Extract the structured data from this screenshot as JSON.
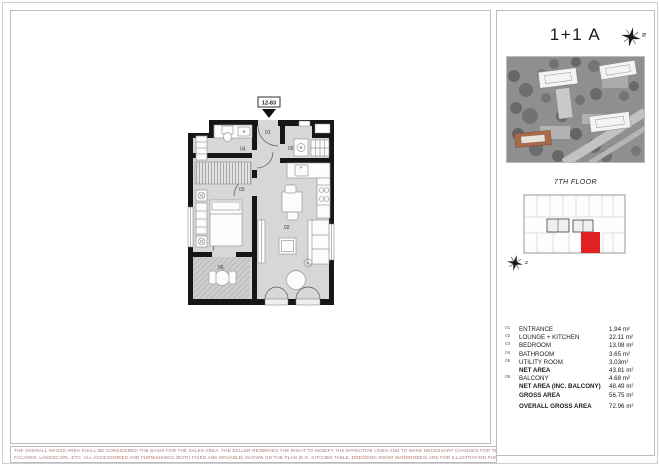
{
  "sheet": {
    "title": "1+1 A",
    "floor_label": "7TH FLOOR",
    "unit_code": "12-83",
    "north_letter": "N"
  },
  "plan": {
    "labels": {
      "entrance": "01",
      "lounge_kitchen": "02",
      "bedroom": "03",
      "bathroom": "04",
      "utility": "05",
      "balcony": "06"
    }
  },
  "legend": {
    "rows": [
      {
        "num": "01",
        "label": "ENTRANCE",
        "value": "1.94 m²"
      },
      {
        "num": "02",
        "label": "LOUNGE + KITCHEN",
        "value": "22.11 m²"
      },
      {
        "num": "03",
        "label": "BEDROOM",
        "value": "13.08 m²"
      },
      {
        "num": "04",
        "label": "BATHROOM",
        "value": "3.65 m²"
      },
      {
        "num": "05",
        "label": "UTILITY ROOM",
        "value": "3.03m²"
      },
      {
        "num": "",
        "label": "NET AREA",
        "value": "43.81 m²"
      },
      {
        "num": "06",
        "label": "BALCONY",
        "value": "4.68 m²"
      },
      {
        "num": "",
        "label": "NET AREA (INC. BALCONY)",
        "value": "48.49 m²"
      },
      {
        "num": "",
        "label": "GROSS AREA",
        "value": "56.75 m²"
      },
      {
        "num": "",
        "label": "OVERALL GROSS AREA",
        "value": "72.96 m²"
      }
    ]
  },
  "disclaimer": {
    "line1": "THE OVERALL GROSS AREA SHALL BE CONSIDERED THE BASIS FOR THE SALES AREA. THE SELLER RESERVES THE RIGHT TO MODIFY THE EFFECTIVE LINES AND TO MAKE NECESSARY CHANGES FOR TECHNICAL REASONS IN THE DESIGN OF ITS",
    "line2": "FACADES, LANDSCAPE, ETC. ALL ACCESSORIES AND FURNISHINGS (BOTH FIXED AND MOVABLE) SHOWN ON THE PLAN (E.G. KITCHEN TABLE, DRESSING ROOM WARDROBES) ARE FOR ILLUSTRATION PURPOSES ONLY AND ARE EXCLUDED FROM THE CONTRACT"
  },
  "colors": {
    "highlight_red": "#e02222",
    "wall_black": "#161616",
    "plan_fill": "#d7d7d7",
    "highlight_building": "#a96a4a",
    "disclaimer_text": "#b57272"
  }
}
